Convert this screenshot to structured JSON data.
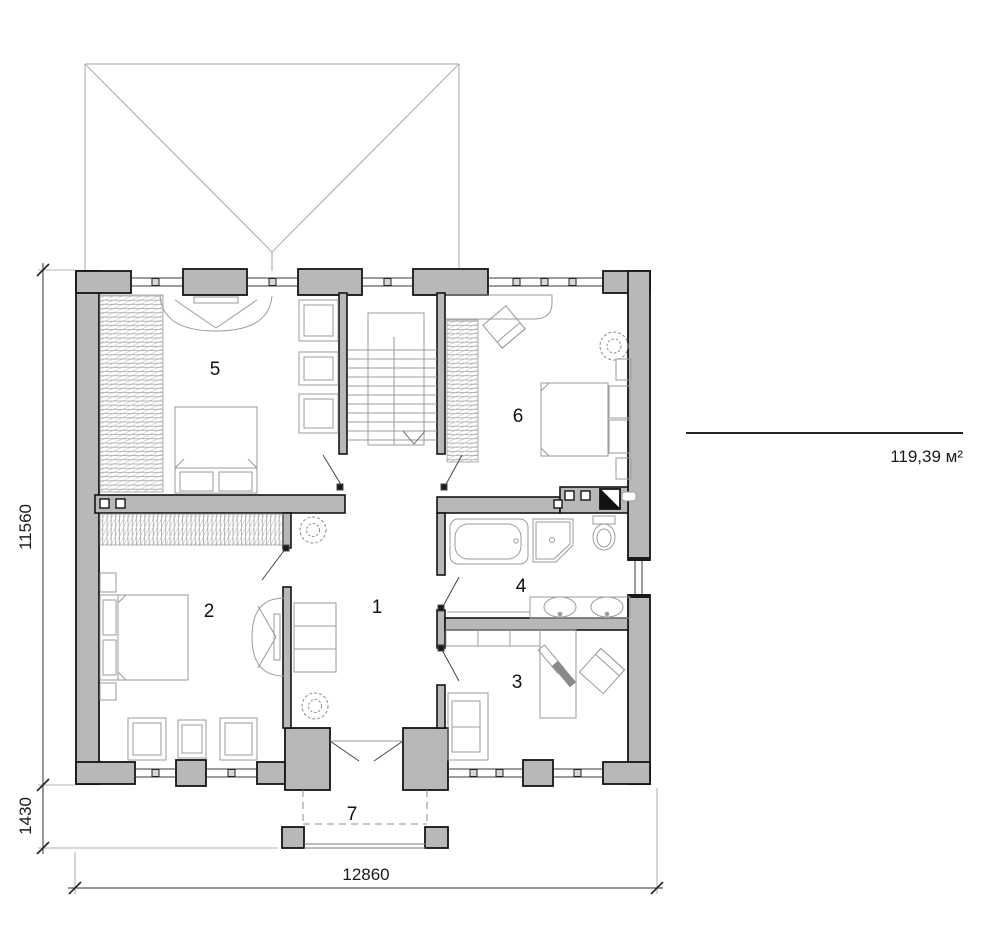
{
  "title": "second-floor-plan",
  "rooms": [
    {
      "number": "1"
    },
    {
      "number": "2"
    },
    {
      "number": "3"
    },
    {
      "number": "4"
    },
    {
      "number": "5"
    },
    {
      "number": "6"
    },
    {
      "number": "7"
    }
  ],
  "dimensions": {
    "height_total": "11560",
    "porch_depth": "1430",
    "width_total": "12860"
  },
  "area": {
    "value": "119,39 м²"
  },
  "colors": {
    "wall_fill": "#b8b8b8",
    "wall_line": "#141414",
    "furniture_line": "#9b9b9b",
    "roof_line": "#b3b3b3",
    "dim_line": "#333333"
  }
}
